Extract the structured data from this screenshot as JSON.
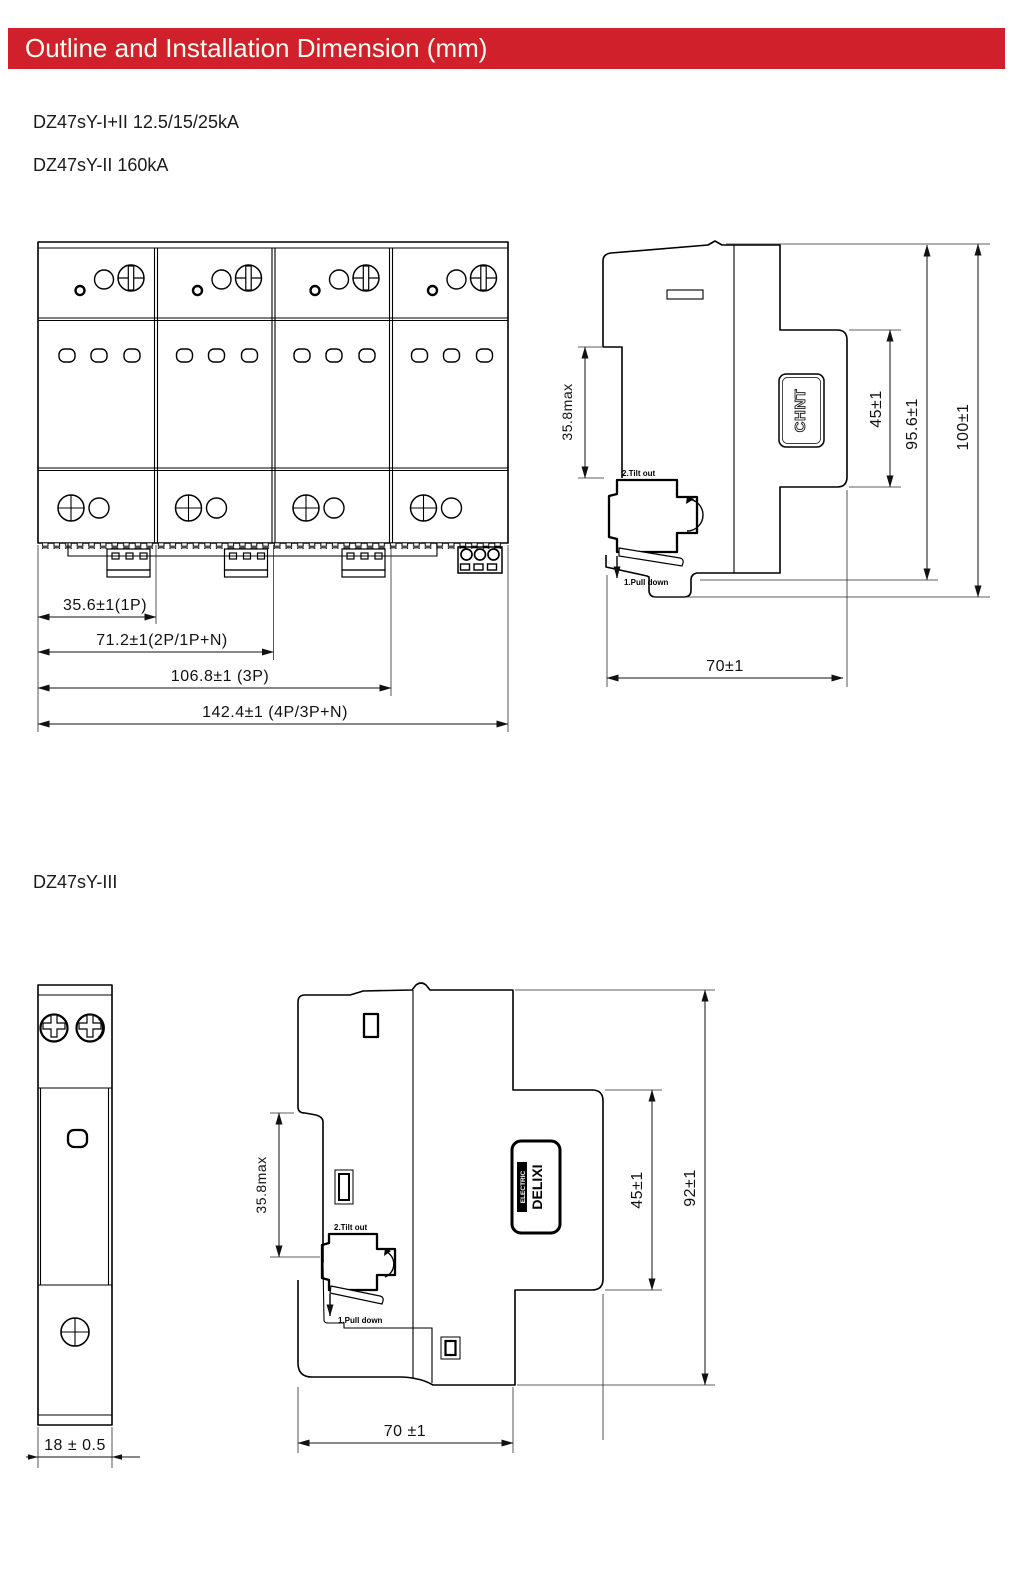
{
  "header": {
    "title": "Outline and Installation Dimension (mm)"
  },
  "models": {
    "model_1_2": "DZ47sY-I+II 12.5/15/25kA",
    "model_2": "DZ47sY-II 160kA",
    "model_3": "DZ47sY-III"
  },
  "colors": {
    "header_bg": "#d0202b",
    "header_fg": "#fffdf2",
    "line": "#000000"
  },
  "drawing_top": {
    "front": {
      "dims": [
        "35.6±1(1P)",
        "71.2±1(2P/1P+N)",
        "106.8±1 (3P)",
        "142.4±1 (4P/3P+N)"
      ]
    },
    "side": {
      "dim_rail_depth": "35.8max",
      "dim_45": "45±1",
      "dim_956": "95.6±1",
      "dim_100": "100±1",
      "dim_width": "70±1",
      "note_step2": "2.Tilt out",
      "note_step1": "1.Pull down",
      "logo": "CHNT"
    }
  },
  "drawing_bottom": {
    "front": {
      "dim_width": "18 ± 0.5"
    },
    "side": {
      "dim_rail_depth": "35.8max",
      "dim_45": "45±1",
      "dim_92": "92±1",
      "dim_width": "70 ±1",
      "note_step2": "2.Tilt out",
      "note_step1": "1.Pull down",
      "logo_line1": "DELIXI",
      "logo_line2": "ELECTRIC"
    }
  }
}
